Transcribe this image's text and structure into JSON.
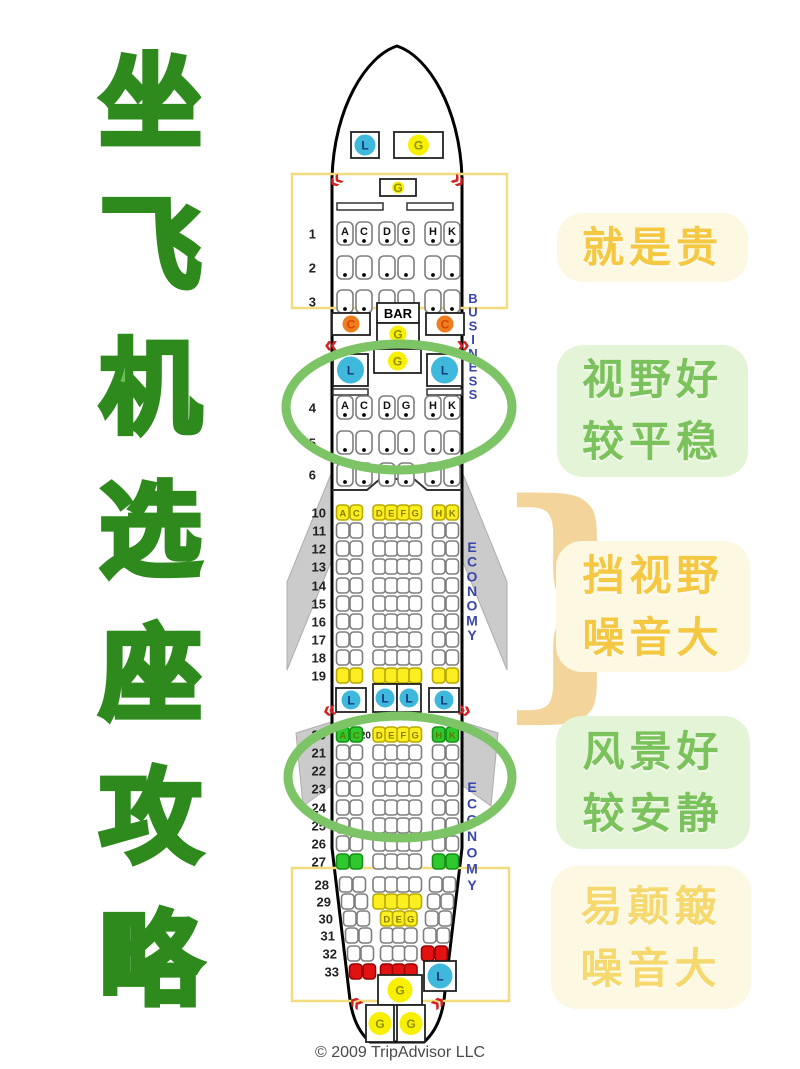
{
  "title": {
    "text": "坐飞机选座攻略",
    "chars": [
      "坐",
      "飞",
      "机",
      "选",
      "座",
      "攻",
      "略"
    ],
    "fill": "#66C24F",
    "outline": "#2E8A1D"
  },
  "tones": {
    "yellow": {
      "bg": "#FDF8E2",
      "text": "#F4C843"
    },
    "green": {
      "bg": "#E4F4D7",
      "text": "#7BC15C"
    }
  },
  "side_labels": [
    {
      "id": "expensive",
      "lines": [
        "就是贵"
      ],
      "tone": "yellow"
    },
    {
      "id": "good-view-stable",
      "lines": [
        "视野好",
        "较平稳"
      ],
      "tone": "green"
    },
    {
      "id": "blocked-view-noisy",
      "lines": [
        "挡视野",
        "噪音大"
      ],
      "tone": "yellow"
    },
    {
      "id": "good-scenery-quiet",
      "lines": [
        "风景好",
        "较安静"
      ],
      "tone": "green"
    },
    {
      "id": "bumpy-noisy",
      "lines": [
        "易颠簸",
        "噪音大"
      ],
      "tone": "yellow",
      "text_color": "#F5D96E"
    }
  ],
  "seatmap": {
    "copyright": "© 2009 TripAdvisor LLC",
    "colors": {
      "seat_fill": {
        "w": "#FFFFFF",
        "y": "#FCEF21",
        "g": "#2FC82F",
        "r": "#E21212"
      },
      "seat_stroke": {
        "w": "#7E7E7E",
        "y": "#B9A900",
        "g": "#159215",
        "r": "#990000"
      },
      "seat_letter": {
        "w": "#111111",
        "y": "#8A7D00",
        "g": "#5C7A00",
        "r": "#FFFFFF"
      },
      "lavatory_circle": "#3EB9DC",
      "lavatory_letter": "#17357F",
      "galley_circle": "#F7F000",
      "galley_letter": "#8F8F00",
      "closet_circle": "#ED7D1F",
      "closet_letter": "#D94400",
      "exit": "#D42121",
      "zone_box": "#F2DC7E",
      "highlight_ellipse": "#7CC465",
      "section_label": "#3A47A8",
      "wing": "#CBCBCB",
      "brace": "#F3D49A"
    },
    "fuselage_path": "M 332,178 C 334,108 366,56 397,46 C 428,56 460,108 462,178 L 462,848 L 444,1000 Q 440,1028 424,1042 L 370,1042 Q 354,1028 350,1000 L 332,848 Z",
    "wings": [
      {
        "name": "wing-left",
        "points": "331,474 331,562 287,670 287,582"
      },
      {
        "name": "wing-right",
        "points": "463,474 463,562 507,670 507,582"
      },
      {
        "name": "wing-flap-left",
        "points": "331,722 331,786 303,806 296,733"
      },
      {
        "name": "wing-flap-right",
        "points": "463,722 463,786 491,806 498,733"
      }
    ],
    "highlight_boxes": [
      {
        "x": 292,
        "y": 174,
        "w": 215,
        "h": 134
      },
      {
        "x": 292,
        "y": 868,
        "w": 217,
        "h": 133
      }
    ],
    "highlight_ellipses": [
      {
        "cx": 399,
        "cy": 407,
        "rx": 113,
        "ry": 63
      },
      {
        "cx": 400,
        "cy": 777,
        "rx": 112,
        "ry": 61
      }
    ],
    "section_labels": [
      {
        "text": "BUSINESS",
        "x": 473,
        "y_top": 303,
        "y_bottom": 399,
        "size": 13
      },
      {
        "text": "ECONOMY",
        "x": 472,
        "y_top": 552,
        "y_bottom": 640,
        "size": 14
      },
      {
        "text": "ECONOMY",
        "x": 472,
        "y_top": 792,
        "y_bottom": 890,
        "size": 14
      }
    ],
    "exits": [
      {
        "g": "«",
        "x": 340,
        "y": 186,
        "r": -38
      },
      {
        "g": "»",
        "x": 454,
        "y": 186,
        "r": 38
      },
      {
        "g": "«",
        "x": 331,
        "y": 352,
        "r": 0
      },
      {
        "g": "»",
        "x": 463,
        "y": 352,
        "r": 0
      },
      {
        "g": "«",
        "x": 331,
        "y": 717,
        "r": -12
      },
      {
        "g": "»",
        "x": 463,
        "y": 717,
        "r": 12
      },
      {
        "g": "«",
        "x": 352,
        "y": 1008,
        "r": 38
      },
      {
        "g": "»",
        "x": 442,
        "y": 1008,
        "r": -38
      }
    ],
    "facilities": [
      {
        "letter": "L",
        "kind": "lavatory",
        "x": 351,
        "y": 132,
        "w": 28,
        "h": 26
      },
      {
        "letter": "G",
        "kind": "galley",
        "x": 394,
        "y": 132,
        "w": 49,
        "h": 26
      },
      {
        "letter": "G",
        "kind": "galley",
        "x": 380,
        "y": 179,
        "w": 36,
        "h": 17
      },
      {
        "letter": "BAR",
        "kind": "bar",
        "x": 377,
        "y": 303,
        "w": 42,
        "h": 20
      },
      {
        "letter": "G",
        "kind": "galley",
        "x": 377,
        "y": 323,
        "w": 42,
        "h": 22
      },
      {
        "letter": "C",
        "kind": "closet",
        "x": 332,
        "y": 313,
        "w": 38,
        "h": 22
      },
      {
        "letter": "C",
        "kind": "closet",
        "x": 426,
        "y": 313,
        "w": 38,
        "h": 22
      },
      {
        "letter": "L",
        "kind": "lavatory",
        "x": 333,
        "y": 354,
        "w": 35,
        "h": 32
      },
      {
        "letter": "G",
        "kind": "galley",
        "x": 374,
        "y": 349,
        "w": 47,
        "h": 24
      },
      {
        "letter": "L",
        "kind": "lavatory",
        "x": 427,
        "y": 354,
        "w": 35,
        "h": 32
      },
      {
        "letter": "L",
        "kind": "lavatory",
        "x": 336,
        "y": 688,
        "w": 30,
        "h": 24
      },
      {
        "letter": "L",
        "kind": "lavatory",
        "x": 373,
        "y": 684,
        "w": 24,
        "h": 28
      },
      {
        "letter": "L",
        "kind": "lavatory",
        "x": 397,
        "y": 684,
        "w": 24,
        "h": 28
      },
      {
        "letter": "L",
        "kind": "lavatory",
        "x": 429,
        "y": 688,
        "w": 30,
        "h": 24
      },
      {
        "letter": "G",
        "kind": "galley",
        "x": 378,
        "y": 975,
        "w": 44,
        "h": 30
      },
      {
        "letter": "L",
        "kind": "lavatory",
        "x": 424,
        "y": 961,
        "w": 32,
        "h": 30
      },
      {
        "letter": "G",
        "kind": "galley",
        "x": 366,
        "y": 1005,
        "w": 28,
        "h": 37
      },
      {
        "letter": "G",
        "kind": "galley",
        "x": 397,
        "y": 1005,
        "w": 28,
        "h": 37
      }
    ],
    "rows": [
      {
        "n": "1",
        "t": "b",
        "y": 222,
        "g": [
          [
            "A:w",
            "C:w"
          ],
          [
            "D:w",
            "G:w"
          ],
          [
            "H:w",
            "K:w"
          ]
        ]
      },
      {
        "n": "2",
        "t": "b",
        "y": 256,
        "g": [
          [
            ":w",
            ":w"
          ],
          [
            ":w",
            ":w"
          ],
          [
            ":w",
            ":w"
          ]
        ]
      },
      {
        "n": "3",
        "t": "b",
        "y": 290,
        "g": [
          [
            ":w",
            ":w"
          ],
          [
            ":w",
            ":w"
          ],
          [
            ":w",
            ":w"
          ]
        ]
      },
      {
        "n": "4",
        "t": "b",
        "y": 396,
        "g": [
          [
            "A:w",
            "C:w"
          ],
          [
            "D:w",
            "G:w"
          ],
          [
            "H:w",
            "K:w"
          ]
        ]
      },
      {
        "n": "5",
        "t": "b",
        "y": 431,
        "g": [
          [
            ":w",
            ":w"
          ],
          [
            ":w",
            ":w"
          ],
          [
            ":w",
            ":w"
          ]
        ]
      },
      {
        "n": "6",
        "t": "b",
        "y": 463,
        "g": [
          [
            ":w",
            ":w"
          ],
          [
            ":w",
            ":w"
          ],
          [
            ":w",
            ":w"
          ]
        ]
      },
      {
        "n": "10",
        "t": "e",
        "y": 505,
        "g": [
          [
            "A:y",
            "C:y"
          ],
          [
            "D:y",
            "E:y",
            "F:y",
            "G:y"
          ],
          [
            "H:y",
            "K:y"
          ]
        ]
      },
      {
        "n": "11",
        "t": "e",
        "y": 523,
        "g": [
          [
            ":w",
            ":w"
          ],
          [
            ":w",
            ":w",
            ":w",
            ":w"
          ],
          [
            ":w",
            ":w"
          ]
        ]
      },
      {
        "n": "12",
        "t": "e",
        "y": 541,
        "g": [
          [
            ":w",
            ":w"
          ],
          [
            ":w",
            ":w",
            ":w",
            ":w"
          ],
          [
            ":w",
            ":w"
          ]
        ]
      },
      {
        "n": "13",
        "t": "e",
        "y": 559,
        "g": [
          [
            ":w",
            ":w"
          ],
          [
            ":w",
            ":w",
            ":w",
            ":w"
          ],
          [
            ":w",
            ":w"
          ]
        ]
      },
      {
        "n": "14",
        "t": "e",
        "y": 578,
        "g": [
          [
            ":w",
            ":w"
          ],
          [
            ":w",
            ":w",
            ":w",
            ":w"
          ],
          [
            ":w",
            ":w"
          ]
        ]
      },
      {
        "n": "15",
        "t": "e",
        "y": 596,
        "g": [
          [
            ":w",
            ":w"
          ],
          [
            ":w",
            ":w",
            ":w",
            ":w"
          ],
          [
            ":w",
            ":w"
          ]
        ]
      },
      {
        "n": "16",
        "t": "e",
        "y": 614,
        "g": [
          [
            ":w",
            ":w"
          ],
          [
            ":w",
            ":w",
            ":w",
            ":w"
          ],
          [
            ":w",
            ":w"
          ]
        ]
      },
      {
        "n": "17",
        "t": "e",
        "y": 632,
        "g": [
          [
            ":w",
            ":w"
          ],
          [
            ":w",
            ":w",
            ":w",
            ":w"
          ],
          [
            ":w",
            ":w"
          ]
        ]
      },
      {
        "n": "18",
        "t": "e",
        "y": 650,
        "g": [
          [
            ":w",
            ":w"
          ],
          [
            ":w",
            ":w",
            ":w",
            ":w"
          ],
          [
            ":w",
            ":w"
          ]
        ]
      },
      {
        "n": "19",
        "t": "e",
        "y": 668,
        "g": [
          [
            ":y",
            ":y"
          ],
          [
            ":y",
            ":y",
            ":y",
            ":y"
          ],
          [
            ":y",
            ":y"
          ]
        ]
      },
      {
        "n": "20",
        "t": "e",
        "y": 727,
        "p": "20",
        "g": [
          [
            "A:g",
            "C:g"
          ],
          [
            "D:y",
            "E:y",
            "F:y",
            "G:y"
          ],
          [
            "H:g",
            "K:g"
          ]
        ]
      },
      {
        "n": "21",
        "t": "e",
        "y": 745,
        "g": [
          [
            ":w",
            ":w"
          ],
          [
            ":w",
            ":w",
            ":w",
            ":w"
          ],
          [
            ":w",
            ":w"
          ]
        ]
      },
      {
        "n": "22",
        "t": "e",
        "y": 763,
        "g": [
          [
            ":w",
            ":w"
          ],
          [
            ":w",
            ":w",
            ":w",
            ":w"
          ],
          [
            ":w",
            ":w"
          ]
        ]
      },
      {
        "n": "23",
        "t": "e",
        "y": 781,
        "g": [
          [
            ":w",
            ":w"
          ],
          [
            ":w",
            ":w",
            ":w",
            ":w"
          ],
          [
            ":w",
            ":w"
          ]
        ]
      },
      {
        "n": "24",
        "t": "e",
        "y": 800,
        "g": [
          [
            ":w",
            ":w"
          ],
          [
            ":w",
            ":w",
            ":w",
            ":w"
          ],
          [
            ":w",
            ":w"
          ]
        ]
      },
      {
        "n": "25",
        "t": "e",
        "y": 818,
        "g": [
          [
            ":w",
            ":w"
          ],
          [
            ":w",
            ":w",
            ":w",
            ":w"
          ],
          [
            ":w",
            ":w"
          ]
        ]
      },
      {
        "n": "26",
        "t": "e",
        "y": 836,
        "g": [
          [
            ":w",
            ":w"
          ],
          [
            ":w",
            ":w",
            ":w",
            ":w"
          ],
          [
            ":w",
            ":w"
          ]
        ]
      },
      {
        "n": "27",
        "t": "e",
        "y": 854,
        "g": [
          [
            ":g",
            ":g"
          ],
          [
            ":w",
            ":w",
            ":w",
            ":w"
          ],
          [
            ":g",
            ":g"
          ]
        ]
      },
      {
        "n": "28",
        "t": "e",
        "y": 877,
        "sh": 3,
        "g": [
          [
            ":w",
            ":w"
          ],
          [
            ":w",
            ":w",
            ":w",
            ":w"
          ],
          [
            ":w",
            ":w"
          ]
        ]
      },
      {
        "n": "29",
        "t": "e",
        "y": 894,
        "sh": 5,
        "g": [
          [
            ":w",
            ":w"
          ],
          [
            ":y",
            ":y",
            ":y",
            ":y"
          ],
          [
            ":w",
            ":w"
          ]
        ]
      },
      {
        "n": "30",
        "t": "e",
        "y": 911,
        "sh": 7,
        "g": [
          [
            ":w",
            ":w"
          ],
          [
            "D:y",
            "E:y",
            "G:y"
          ],
          [
            ":w",
            ":w"
          ]
        ]
      },
      {
        "n": "31",
        "t": "e",
        "y": 928,
        "sh": 9,
        "g": [
          [
            ":w",
            ":w"
          ],
          [
            ":w",
            ":w",
            ":w"
          ],
          [
            ":w",
            ":w"
          ]
        ]
      },
      {
        "n": "32",
        "t": "e",
        "y": 946,
        "sh": 11,
        "g": [
          [
            ":w",
            ":w"
          ],
          [
            ":w",
            ":w",
            ":w"
          ],
          [
            ":r",
            ":r"
          ]
        ]
      },
      {
        "n": "33",
        "t": "e",
        "y": 964,
        "sh": 13,
        "g": [
          [
            ":r",
            ":r"
          ],
          [
            ":r",
            ":r",
            ":r"
          ],
          null
        ]
      }
    ],
    "brace": {
      "glyph": "}",
      "x": 494,
      "y": 684,
      "size": 252
    }
  }
}
